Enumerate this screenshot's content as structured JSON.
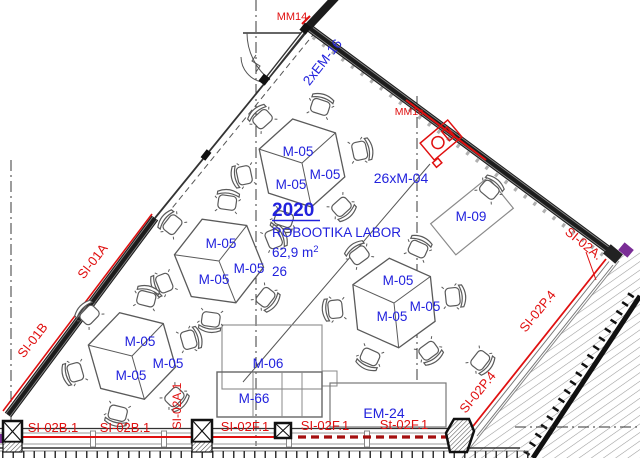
{
  "drawing": {
    "room": {
      "number": "2020",
      "name": "ROBOOTIKA LABOR",
      "area_main": "62,9 m",
      "area_sup": "2",
      "capacity": "26"
    },
    "furniture": {
      "group_table": "M-05",
      "chair_count": "26xM-04",
      "desk": "M-09",
      "cabinet_top": "M-06",
      "cabinet_bottom": "M-66",
      "equipment_rack": "EM-24",
      "door_unit": "2xEM-16"
    },
    "walls": {
      "left_upper": "SI-01A",
      "left_lower": "SI-01B",
      "bottom_left_1": "SI-02B.1",
      "bottom_left_2": "SI-02B.1",
      "bottom_pier": "SI-02A.1",
      "bottom_mid_1": "SI-02F.1",
      "bottom_mid_2": "SI-02F.1",
      "bottom_mid_3": "St-02F.1",
      "right_diag_upper": "SI-02P.4",
      "right_diag_lower": "SI-02P.4",
      "right_corner": "SI-02A.",
      "door_marker": "MM14",
      "sensor_marker": "MM1c"
    },
    "colors": {
      "label_blue": "#2222dd",
      "label_red": "#e01010",
      "dashed_red": "#a50f0f",
      "wall_dark": "#1c1c1c"
    }
  }
}
